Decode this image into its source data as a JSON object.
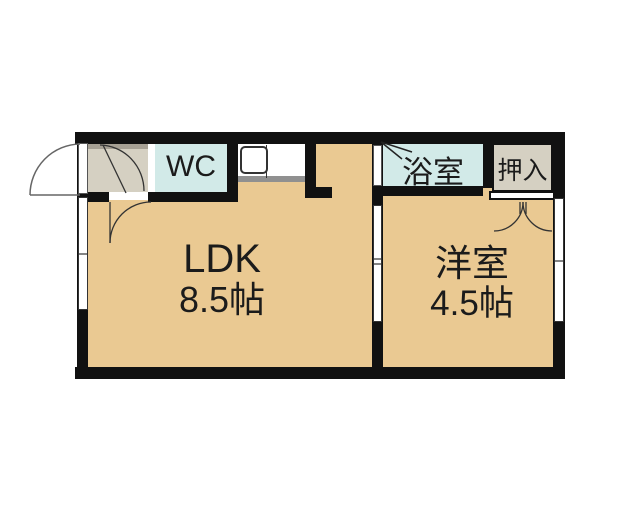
{
  "plan": {
    "rooms": {
      "ldk": {
        "name": "LDK",
        "size": "8.5帖"
      },
      "western": {
        "name": "洋室",
        "size": "4.5帖"
      },
      "wc": {
        "name": "WC"
      },
      "bath": {
        "name": "浴室"
      },
      "closet": {
        "name": "押入"
      }
    }
  },
  "colors": {
    "background": "#ffffff",
    "floor": "#eac992",
    "entry_floor": "#d5d0c2",
    "entry_shadow": "#a6a094",
    "wet_floor": "#d2eae8",
    "wall": "#111111",
    "counter_edge": "#909090",
    "line": "#333333",
    "text": "#1b1b1b"
  }
}
